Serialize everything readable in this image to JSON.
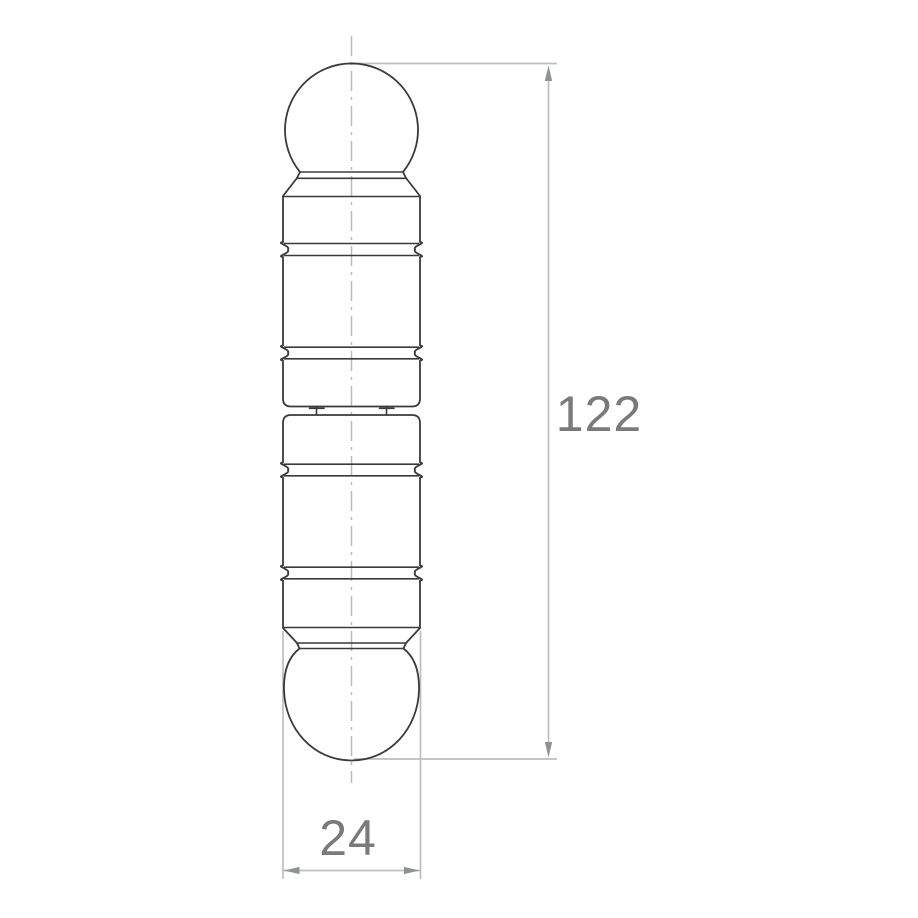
{
  "drawing": {
    "type": "technical-dimension-drawing",
    "subject": "ball-tip-pin",
    "dimensions": {
      "height": "122",
      "width": "24"
    },
    "colors": {
      "background": "#ffffff",
      "part_outline": "#3a3a3a",
      "dimension_line": "#bcbfc1",
      "arrowhead": "#8f9294",
      "dimension_text": "#7a7a7a",
      "centerline": "#b7bbbd"
    }
  }
}
